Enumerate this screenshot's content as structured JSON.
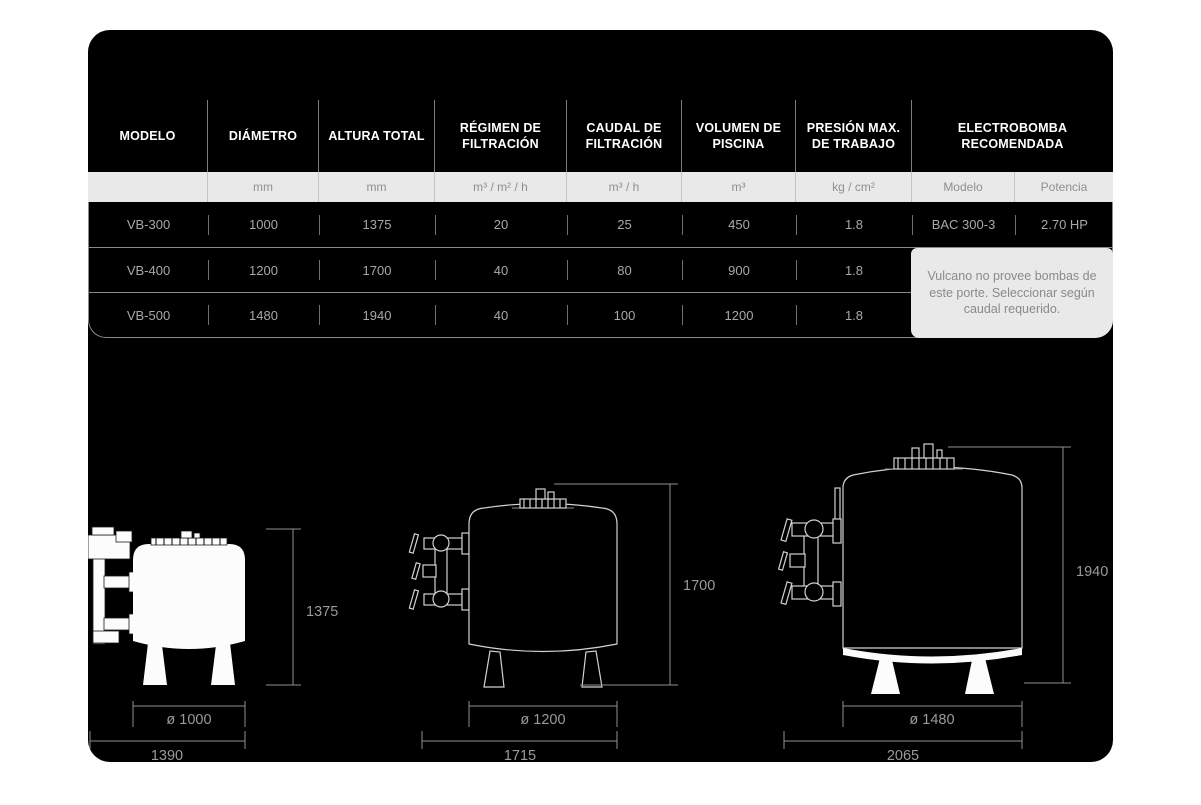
{
  "colors": {
    "card_bg": "#000000",
    "units_bg": "#e9e9e9",
    "note_bg": "#e9e9e9",
    "header_text": "#ffffff",
    "data_text": "#a8a8a8",
    "dim_line": "#8f8f8f"
  },
  "table": {
    "headers": [
      "MODELO",
      "DIÁMETRO",
      "ALTURA TOTAL",
      "RÉGIMEN DE FILTRACIÓN",
      "CAUDAL DE FILTRACIÓN",
      "VOLUMEN DE PISCINA",
      "PRESIÓN MAX. DE TRABAJO",
      "ELECTROBOMBA RECOMENDADA"
    ],
    "units": [
      "",
      "mm",
      "mm",
      "m³ / m² / h",
      "m³ / h",
      "m³",
      "kg / cm²",
      "Modelo",
      "Potencia"
    ],
    "rows": [
      [
        "VB-300",
        "1000",
        "1375",
        "20",
        "25",
        "450",
        "1.8",
        "BAC 300-3",
        "2.70 HP"
      ],
      [
        "VB-400",
        "1200",
        "1700",
        "40",
        "80",
        "900",
        "1.8",
        "",
        ""
      ],
      [
        "VB-500",
        "1480",
        "1940",
        "40",
        "100",
        "1200",
        "1.8",
        "",
        ""
      ]
    ],
    "note": "Vulcano no provee bombas de este porte. Seleccionar según caudal requerido."
  },
  "diagrams": [
    {
      "model": "VB-300",
      "height_label": "1375",
      "diameter_label": "ø 1000",
      "width_label": "1390"
    },
    {
      "model": "VB-400",
      "height_label": "1700",
      "diameter_label": "ø 1200",
      "width_label": "1715"
    },
    {
      "model": "VB-500",
      "height_label": "1940",
      "diameter_label": "ø 1480",
      "width_label": "2065"
    }
  ]
}
